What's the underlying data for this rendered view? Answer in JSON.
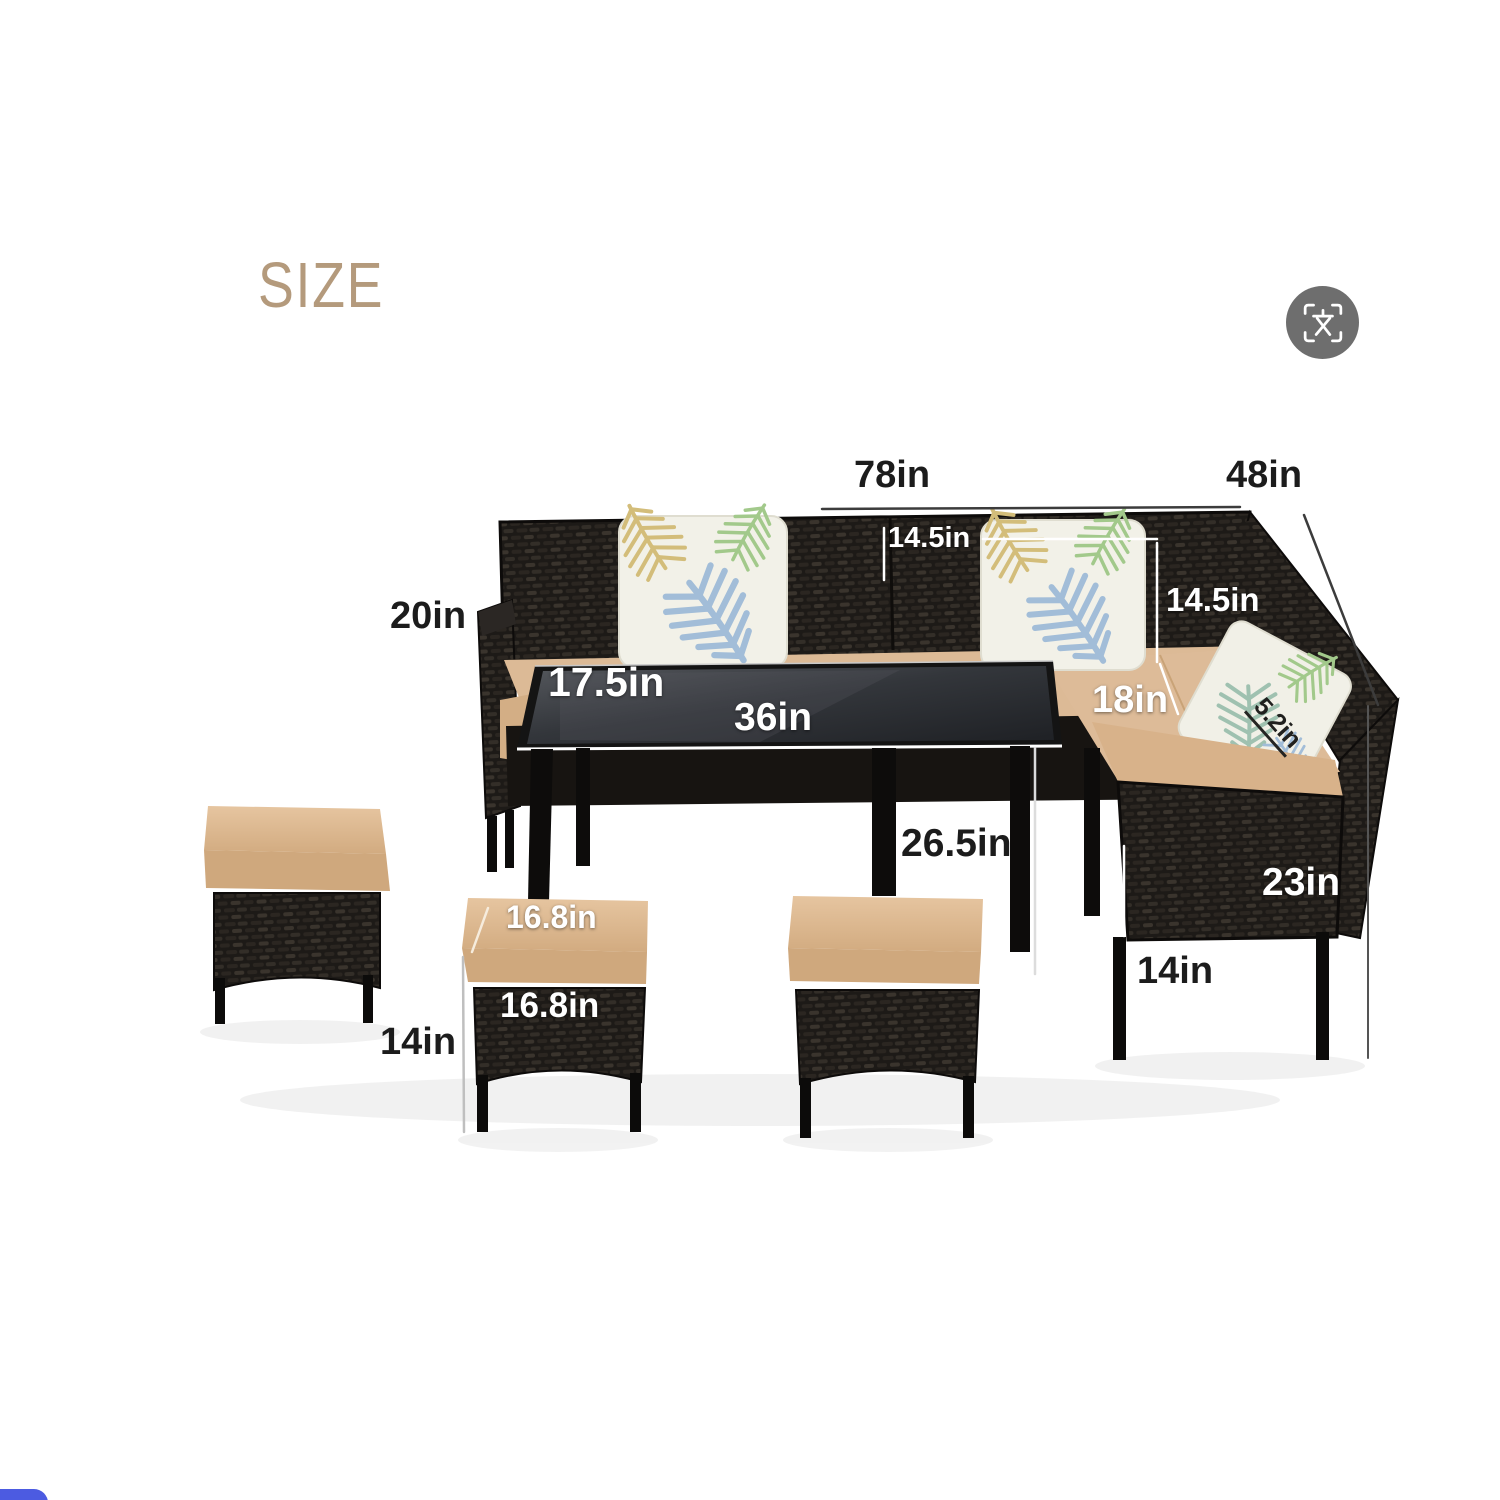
{
  "title": "SIZE",
  "dimensions": {
    "sofa_total_width": "78in",
    "sofa_total_depth": "48in",
    "back_cushion_width": "14.5in",
    "back_cushion_height": "14.5in",
    "arm_height": "20in",
    "table_depth": "17.5in",
    "table_length": "36in",
    "seat_depth": "18in",
    "seat_cushion_thickness": "5.2in",
    "table_height": "26.5in",
    "chair_back_height": "23in",
    "chair_leg_height": "14in",
    "ottoman_top_width": "16.8in",
    "ottoman_front_width": "16.8in",
    "ottoman_leg_height": "14in"
  },
  "icons": {
    "translate": "translate-icon (scan frame with CJK character)"
  },
  "colors": {
    "title": "#b49a7c",
    "label_dark": "#1c1c1c",
    "label_light": "#ffffff",
    "wicker_black": "#1d1a17",
    "cushion_tan": "#ddbb96",
    "floating_button_blue": "#4c5be1"
  }
}
